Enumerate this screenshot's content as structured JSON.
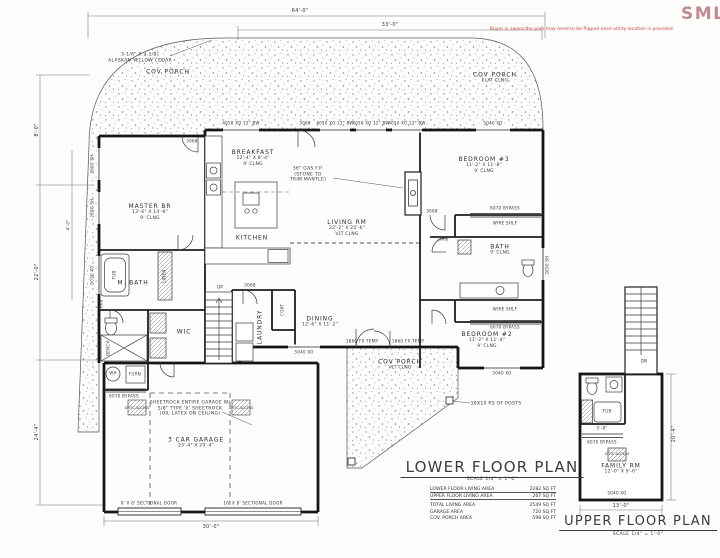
{
  "watermark": {
    "text": "SMLS",
    "color": "#c08b90"
  },
  "disclaimer": "Buyer is aware the plan may need to be flipped once utility location is provided.",
  "lower": {
    "title": "LOWER FLOOR PLAN",
    "scale": "SCALE 1/4\" = 1'-0\"",
    "area_table": [
      {
        "label": "LOWER FLOOR LIVING AREA",
        "value": "2282 SQ FT"
      },
      {
        "label": "UPPER FLOOR LIVING AREA",
        "value": "267 SQ FT"
      },
      {
        "label": "TOTAL LIVING AREA",
        "value": "2549 SQ FT"
      },
      {
        "label": "GARAGE AREA",
        "value": "720 SQ FT"
      },
      {
        "label": "COV. PORCH AREA",
        "value": "598 SQ FT"
      }
    ],
    "rooms": {
      "cov_porch_top": {
        "name": "COV PORCH"
      },
      "cov_porch_right": {
        "name": "COV PORCH",
        "ceil": "FLAT CLNG"
      },
      "cov_porch_bottom": {
        "name": "COV PORCH",
        "ceil": "VLT CLNG"
      },
      "breakfast": {
        "name": "BREAKFAST",
        "dims": "12'-4\" X 8'-4\"",
        "ceil": "9' CLNG"
      },
      "bedroom3": {
        "name": "BEDROOM #3",
        "dims": "11'-2\" X 11'-8\"",
        "ceil": "9' CLNG"
      },
      "master": {
        "name": "MASTER BR",
        "dims": "13'-6\" X 14'-6\"",
        "ceil": "9' CLNG"
      },
      "kitchen": {
        "name": "KITCHEN"
      },
      "living": {
        "name": "LIVING RM",
        "dims": "22'-2\" X 25'-6\"",
        "ceil": "VLT CLNG"
      },
      "mbath": {
        "name": "M. BATH"
      },
      "bath": {
        "name": "BATH",
        "ceil": "9' CLNG"
      },
      "wic": {
        "name": "WIC"
      },
      "laundry": {
        "name": "LAUNDRY"
      },
      "dining": {
        "name": "DINING",
        "dims": "12'-6\" X 11'-2\""
      },
      "bedroom2": {
        "name": "BEDROOM #2",
        "dims": "11'-2\" X 11'-4\"",
        "ceil": "9' CLNG"
      },
      "garage": {
        "name": "3 CAR GARAGE",
        "dims": "23'-4\" X 29'-4\""
      }
    },
    "notes": {
      "cedar": "3-1/8\" X 3-1/8\"\nALASKAN YELLOW CEDAR",
      "fireplace": "36\" GAS F.P.\n(STONE TO\nTRIM MANTLE)",
      "sheetrock": "SHEETROCK ENTIRE GARAGE W/\n5/8\" TYPE 'X' SHEETROCK\n(OIL LATEX ON CEILING)",
      "posts": "10X10 RS OF POSTS",
      "door9": "9' X 8' SECTIONAL DOOR",
      "door16": "16' X 8' SECTIONAL DOOR"
    },
    "dims": {
      "overall": "64'-0\"",
      "porch": "33'-0\"",
      "left_top": "8'-0\"",
      "left_mid": "22'-0\"",
      "left_inner": "4'-0\"",
      "left_bot": "24'-4\"",
      "garage": "30'-0\""
    }
  },
  "upper": {
    "title": "UPPER FLOOR PLAN",
    "scale": "SCALE 1/4\" = 1'-0\"",
    "family": {
      "name": "FAMILY RM",
      "dims": "12'-0\" X 9'-6\""
    },
    "dims": {
      "width": "13'-0\"",
      "height": "20'-4\"",
      "bath": "5'-8\""
    }
  },
  "tags": {
    "d3068": "3068",
    "d2668": "2668",
    "bypass": "6070 BYPASS",
    "wire": "WIRE SHLF",
    "w5040": "5040 XO",
    "w4050": "4050 XO 12\" BW",
    "w2650": "2650 SH",
    "w5030": "5030 XO",
    "w1860": "1860 FX TEMP",
    "up": "UP",
    "dn": "DN",
    "wh": "WH",
    "furn": "FURN",
    "tub": "TUB",
    "bench": "BENCH",
    "linen": "LINEN",
    "coat": "COAT",
    "attic": "ATTIC ACCESS"
  }
}
